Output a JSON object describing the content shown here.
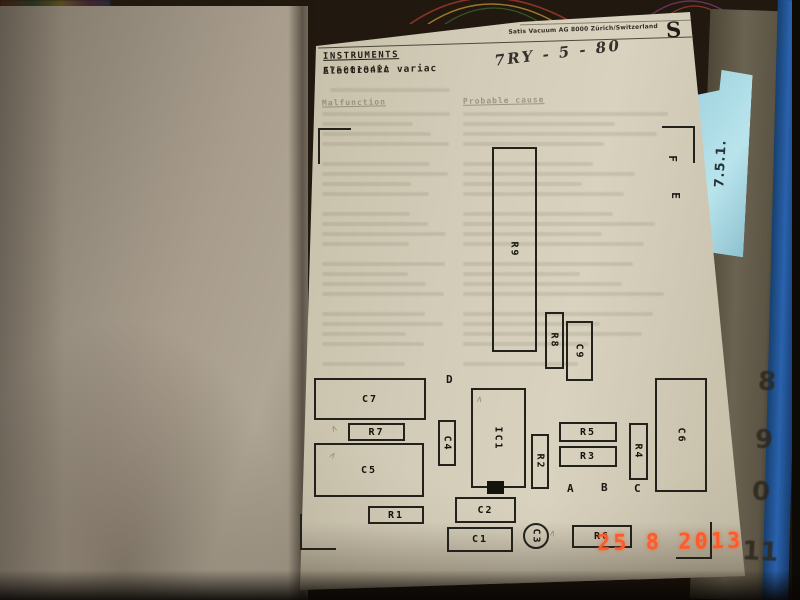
{
  "photo": {
    "date_stamp": "25 8 2013",
    "edge_numbers": [
      "8",
      "9",
      "0",
      "11"
    ],
    "tab_label": "7.5.1."
  },
  "document": {
    "company_header": "Satis Vacuum AG 8000 Zürich/Switzerland",
    "logo": "S",
    "title": "INSTRUMENTS",
    "subtitle_bold": "Electronic variac",
    "part_number": "A7500104PA",
    "handwritten_note": "7RY - 5 - 80",
    "table_headers": {
      "left": "Malfunction",
      "right": "Probable cause"
    }
  },
  "diagram": {
    "components": [
      {
        "label": "R9",
        "x": 492,
        "y": 147,
        "w": 45,
        "h": 205,
        "vert": true
      },
      {
        "label": "R8",
        "x": 545,
        "y": 312,
        "w": 19,
        "h": 57,
        "vert": true
      },
      {
        "label": "C9",
        "x": 566,
        "y": 321,
        "w": 27,
        "h": 60,
        "vert": true
      },
      {
        "label": "C7",
        "x": 314,
        "y": 378,
        "w": 112,
        "h": 42
      },
      {
        "label": "R7",
        "x": 348,
        "y": 423,
        "w": 57,
        "h": 18
      },
      {
        "label": "C5",
        "x": 314,
        "y": 443,
        "w": 110,
        "h": 54
      },
      {
        "label": "R1",
        "x": 368,
        "y": 506,
        "w": 56,
        "h": 18
      },
      {
        "label": "C4",
        "x": 438,
        "y": 420,
        "w": 18,
        "h": 46,
        "vert": true
      },
      {
        "label": "IC1",
        "x": 471,
        "y": 388,
        "w": 55,
        "h": 100,
        "vert": true
      },
      {
        "label": "R2",
        "x": 531,
        "y": 434,
        "w": 18,
        "h": 55,
        "vert": true
      },
      {
        "label": "R5",
        "x": 559,
        "y": 422,
        "w": 58,
        "h": 20
      },
      {
        "label": "R3",
        "x": 559,
        "y": 446,
        "w": 58,
        "h": 21
      },
      {
        "label": "R4",
        "x": 629,
        "y": 423,
        "w": 19,
        "h": 57,
        "vert": true
      },
      {
        "label": "C6",
        "x": 655,
        "y": 378,
        "w": 52,
        "h": 114,
        "vert": true
      },
      {
        "label": "C2",
        "x": 455,
        "y": 497,
        "w": 61,
        "h": 26
      },
      {
        "label": "C1",
        "x": 447,
        "y": 527,
        "w": 66,
        "h": 25
      },
      {
        "label": "R6",
        "x": 572,
        "y": 525,
        "w": 60,
        "h": 23
      },
      {
        "label": "C3",
        "x": 523,
        "y": 523,
        "w": 26,
        "h": 26,
        "vert": true,
        "shape": "circle"
      }
    ],
    "letters": [
      {
        "ch": "D",
        "x": 446,
        "y": 373
      },
      {
        "ch": "A",
        "x": 567,
        "y": 482
      },
      {
        "ch": "B",
        "x": 601,
        "y": 481
      },
      {
        "ch": "C",
        "x": 634,
        "y": 482
      },
      {
        "ch": "F",
        "x": 669,
        "y": 152,
        "vert": true
      },
      {
        "ch": "E",
        "x": 672,
        "y": 189,
        "vert": true
      }
    ],
    "pencil_glyph": "∧",
    "pencil_marks": [
      {
        "x": 331,
        "y": 424,
        "r": -25
      },
      {
        "x": 329,
        "y": 451,
        "r": 35
      },
      {
        "x": 476,
        "y": 395,
        "r": 10
      },
      {
        "x": 549,
        "y": 529,
        "r": 15
      }
    ]
  }
}
